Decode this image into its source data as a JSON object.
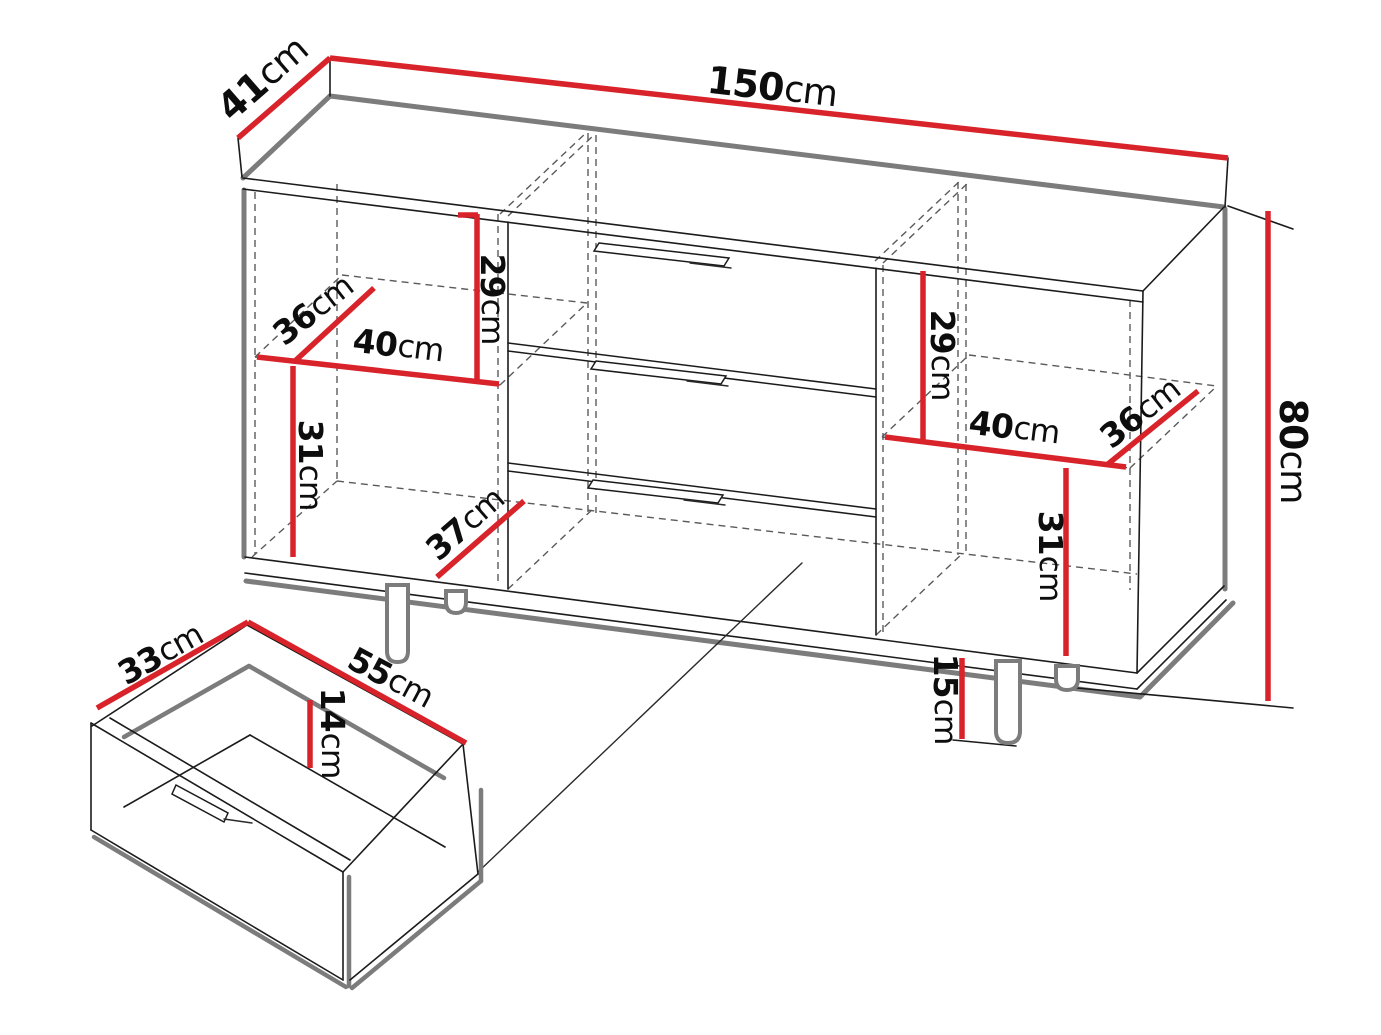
{
  "diagram": {
    "type": "furniture-dimension-diagram",
    "subject": "sideboard-with-drawers-and-detached-drawer-detail",
    "unit": "cm",
    "colors": {
      "dimension_line": "#d8232a",
      "outline": "#1b1b1b",
      "shadow_edge": "#7c7c7c",
      "hidden_edge": "#5a5a5a",
      "background": "#ffffff"
    },
    "dimensions": {
      "overall": {
        "width": "150cm",
        "depth": "41cm",
        "height": "80cm",
        "leg_height": "15cm"
      },
      "left_compartment": {
        "upper_height": "29cm",
        "shelf_depth": "36cm",
        "shelf_width": "40cm",
        "lower_height": "31cm",
        "bottom_depth": "37cm"
      },
      "right_compartment": {
        "upper_height": "29cm",
        "shelf_width": "40cm",
        "shelf_depth": "36cm",
        "lower_height": "31cm"
      },
      "drawer_detail": {
        "inner_depth": "33cm",
        "inner_width": "55cm",
        "inner_height": "14cm"
      }
    },
    "labels": [
      {
        "id": "dim-top-depth",
        "num": "41",
        "unit": "cm",
        "x": 264,
        "y": 80,
        "rot": -41,
        "size": "lg"
      },
      {
        "id": "dim-top-width",
        "num": "150",
        "unit": "cm",
        "x": 772,
        "y": 89,
        "rot": 6.5,
        "size": "lg"
      },
      {
        "id": "dim-right-height",
        "num": "80",
        "unit": "cm",
        "x": 1291,
        "y": 451,
        "rot": 90,
        "size": "lg"
      },
      {
        "id": "dim-left-upper-height",
        "num": "29",
        "unit": "cm",
        "x": 491,
        "y": 299,
        "rot": 90,
        "size": "md"
      },
      {
        "id": "dim-left-shelf-depth",
        "num": "36",
        "unit": "cm",
        "x": 314,
        "y": 311,
        "rot": -38,
        "size": "md"
      },
      {
        "id": "dim-left-shelf-width",
        "num": "40",
        "unit": "cm",
        "x": 398,
        "y": 347,
        "rot": 7,
        "size": "md"
      },
      {
        "id": "dim-left-lower-height",
        "num": "31",
        "unit": "cm",
        "x": 309,
        "y": 465,
        "rot": 90,
        "size": "md"
      },
      {
        "id": "dim-left-bottom-depth",
        "num": "37",
        "unit": "cm",
        "x": 466,
        "y": 525,
        "rot": -41,
        "size": "md"
      },
      {
        "id": "dim-right-upper-height",
        "num": "29",
        "unit": "cm",
        "x": 941,
        "y": 355,
        "rot": 90,
        "size": "md"
      },
      {
        "id": "dim-right-shelf-width",
        "num": "40",
        "unit": "cm",
        "x": 1014,
        "y": 429,
        "rot": 7,
        "size": "md"
      },
      {
        "id": "dim-right-shelf-depth",
        "num": "36",
        "unit": "cm",
        "x": 1141,
        "y": 414,
        "rot": -38,
        "size": "md"
      },
      {
        "id": "dim-right-lower-height",
        "num": "31",
        "unit": "cm",
        "x": 1049,
        "y": 556,
        "rot": 90,
        "size": "md"
      },
      {
        "id": "dim-leg-height",
        "num": "15",
        "unit": "cm",
        "x": 944,
        "y": 699,
        "rot": 90,
        "size": "md"
      },
      {
        "id": "dim-drawer-depth",
        "num": "33",
        "unit": "cm",
        "x": 161,
        "y": 655,
        "rot": -29,
        "size": "md"
      },
      {
        "id": "dim-drawer-width",
        "num": "55",
        "unit": "cm",
        "x": 390,
        "y": 679,
        "rot": 28,
        "size": "md"
      },
      {
        "id": "dim-drawer-height",
        "num": "14",
        "unit": "cm",
        "x": 331,
        "y": 733,
        "rot": 90,
        "size": "md"
      }
    ]
  }
}
